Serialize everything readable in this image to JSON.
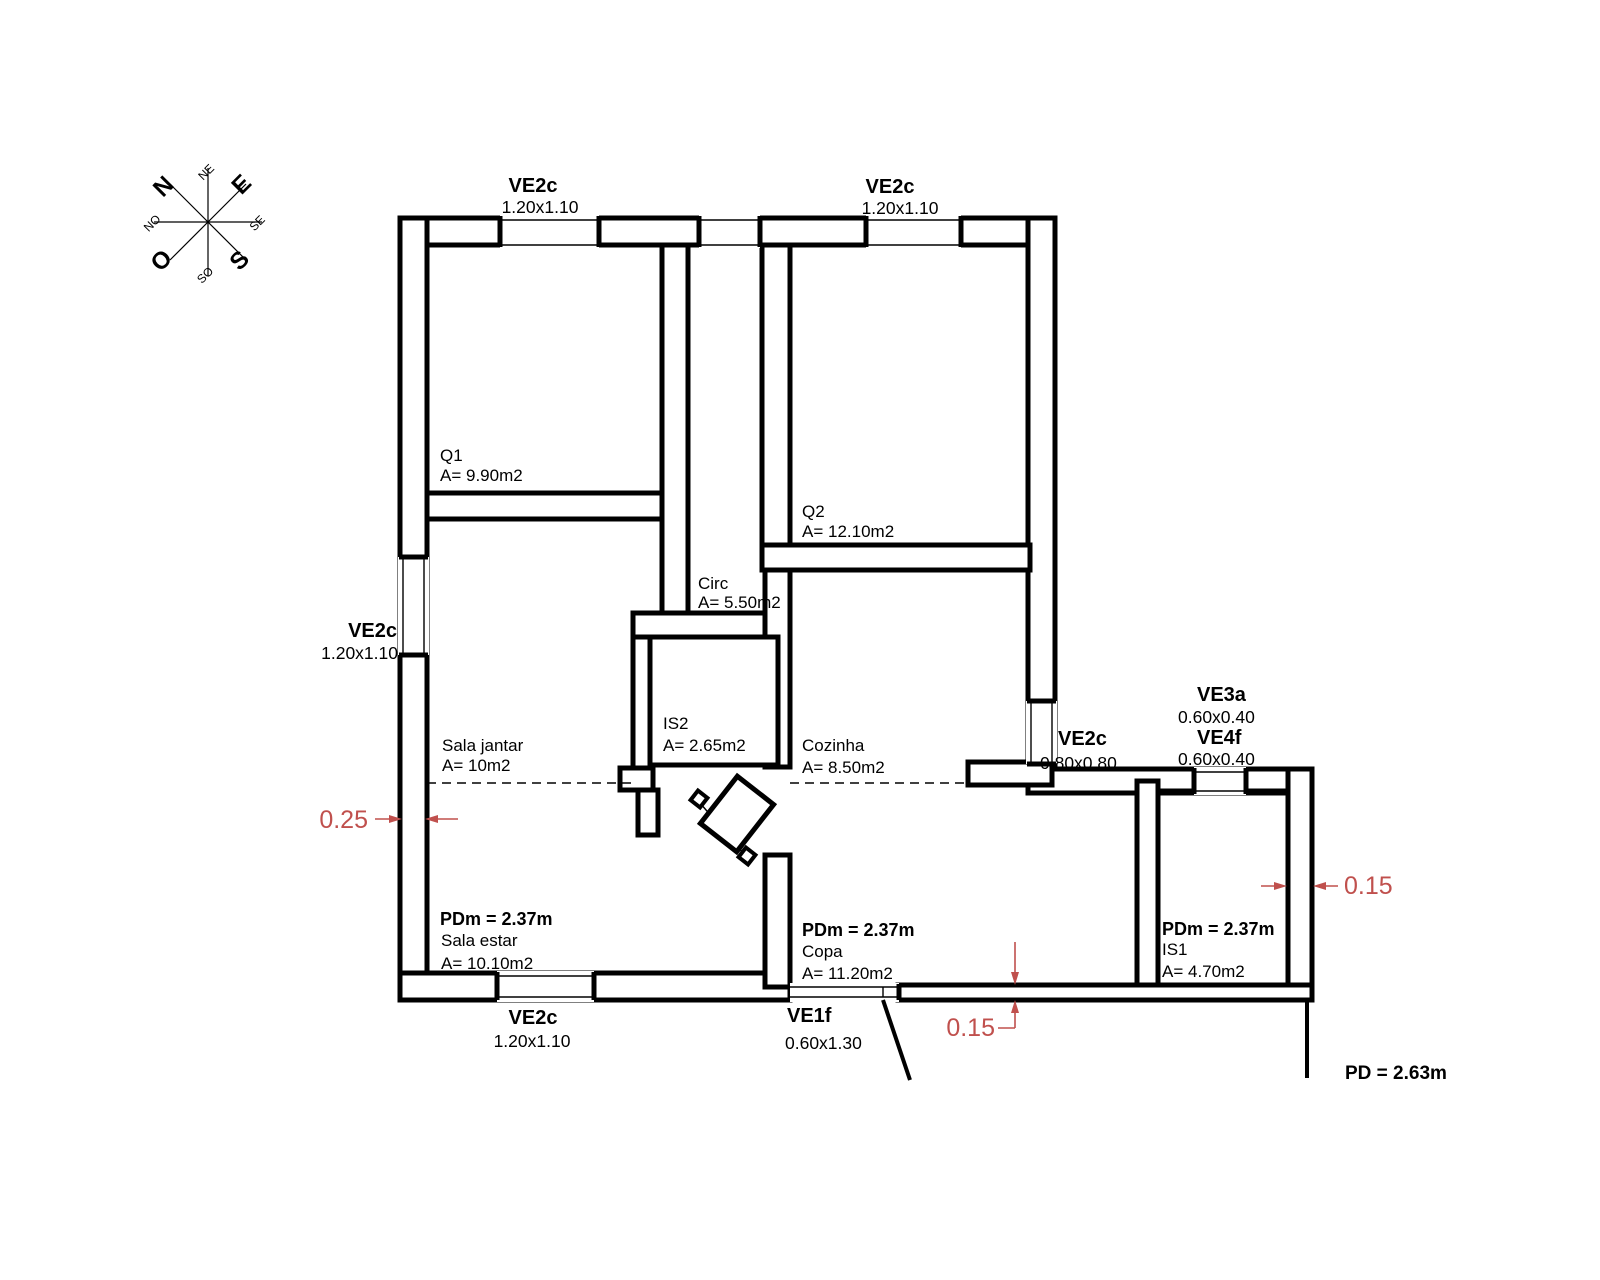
{
  "palette": {
    "ink": "#000000",
    "dim_red": "#c0504d",
    "background": "#ffffff"
  },
  "compass": {
    "cardinals": [
      {
        "label": "N"
      },
      {
        "label": "E"
      },
      {
        "label": "S"
      },
      {
        "label": "O"
      }
    ],
    "intercardinals": [
      {
        "label": "NE"
      },
      {
        "label": "SE"
      },
      {
        "label": "SO"
      },
      {
        "label": "NO"
      }
    ]
  },
  "openings": {
    "ve2c_top_left": {
      "name": "VE2c",
      "size": "1.20x1.10"
    },
    "ve2c_top_right": {
      "name": "VE2c",
      "size": "1.20x1.10"
    },
    "ve2c_left": {
      "name": "VE2c",
      "size": "1.20x1.10"
    },
    "ve2c_bottom": {
      "name": "VE2c",
      "size": "1.20x1.10"
    },
    "ve1f_bottom": {
      "name": "VE1f",
      "size": "0.60x1.30"
    },
    "ve2c_right": {
      "name": "VE2c",
      "size": "0.80x0.80"
    },
    "ve3a_right": {
      "name": "VE3a",
      "size": "0.60x0.40"
    },
    "ve4f_right": {
      "name": "VE4f",
      "size": "0.60x0.40"
    }
  },
  "rooms": {
    "q1": {
      "name": "Q1",
      "area": "A= 9.90m2"
    },
    "q2": {
      "name": "Q2",
      "area": "A= 12.10m2"
    },
    "circ": {
      "name": "Circ",
      "area": "A= 5.50m2"
    },
    "is2": {
      "name": "IS2",
      "area": "A= 2.65m2"
    },
    "cozinha": {
      "name": "Cozinha",
      "area": "A= 8.50m2"
    },
    "sala_jantar": {
      "name": "Sala jantar",
      "area": "A= 10m2"
    },
    "sala_estar": {
      "name": "Sala estar",
      "area": "A= 10.10m2",
      "ceiling": "PDm = 2.37m"
    },
    "copa": {
      "name": "Copa",
      "area": "A= 11.20m2",
      "ceiling": "PDm = 2.37m"
    },
    "is1": {
      "name": "IS1",
      "area": "A= 4.70m2",
      "ceiling": "PDm = 2.37m"
    }
  },
  "dimensions": {
    "wall_left": "0.25",
    "wall_bottom": "0.15",
    "wall_right": "0.15"
  },
  "notes": {
    "ceiling_height": "PD = 2.63m"
  }
}
